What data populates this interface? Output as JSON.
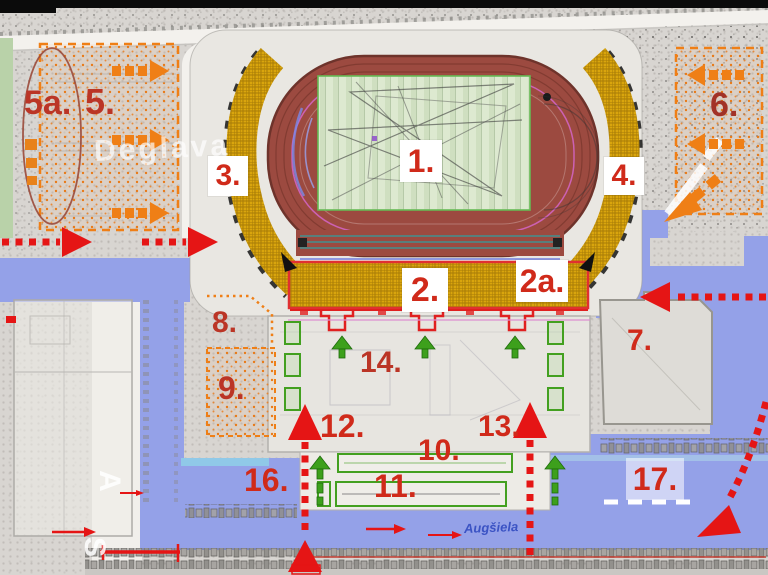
{
  "title": "Stadium site plan with numbered zones and circulation arrows",
  "palette": {
    "track_red": "#9c4a40",
    "field_green": "#dde9d0",
    "stand_gold": "#d9a50d",
    "route_red": "#e51515",
    "flow_orange": "#ef7f16",
    "access_green": "#3da01c",
    "road_blue": "#94a1e8",
    "label_red": "#d02a1a",
    "street_blue": "#3b53c4"
  },
  "labels": [
    {
      "id": "zone-5a",
      "text": "5a."
    },
    {
      "id": "zone-5",
      "text": "5."
    },
    {
      "id": "zone-3",
      "text": "3."
    },
    {
      "id": "zone-1",
      "text": "1."
    },
    {
      "id": "zone-4",
      "text": "4."
    },
    {
      "id": "zone-6",
      "text": "6."
    },
    {
      "id": "zone-2",
      "text": "2."
    },
    {
      "id": "zone-2a",
      "text": "2a."
    },
    {
      "id": "zone-7",
      "text": "7."
    },
    {
      "id": "zone-8",
      "text": "8."
    },
    {
      "id": "zone-9",
      "text": "9."
    },
    {
      "id": "zone-10",
      "text": "10."
    },
    {
      "id": "zone-11",
      "text": "11."
    },
    {
      "id": "zone-12",
      "text": "12."
    },
    {
      "id": "zone-13",
      "text": "13."
    },
    {
      "id": "zone-14",
      "text": "14."
    },
    {
      "id": "zone-16",
      "text": "16."
    },
    {
      "id": "zone-17",
      "text": "17."
    }
  ],
  "streets": {
    "augsiela": "Augšiela"
  },
  "watermarks": {
    "deglava": "Deglava",
    "west_top": "A",
    "west_bottom": "S"
  }
}
